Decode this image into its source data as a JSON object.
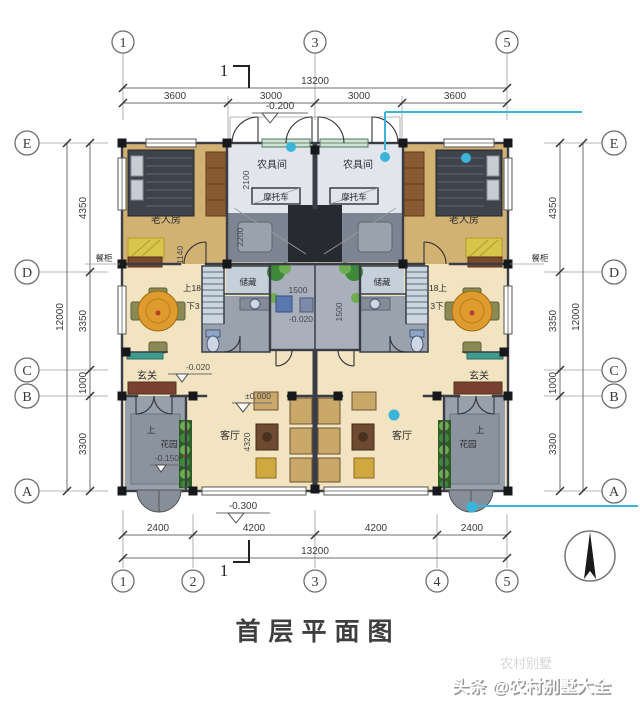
{
  "title": "首层平面图",
  "section_marker": "1",
  "axes": {
    "top": [
      "1",
      "3",
      "5"
    ],
    "bottom": [
      "1",
      "2",
      "3",
      "4",
      "5"
    ],
    "left": [
      "E",
      "D",
      "C",
      "B",
      "A"
    ],
    "right": [
      "E",
      "D",
      "C",
      "B",
      "A"
    ]
  },
  "dimensions": {
    "top": {
      "total": "13200",
      "segments": [
        "3600",
        "3000",
        "3000",
        "3600"
      ]
    },
    "bottom": {
      "total": "13200",
      "segments": [
        "2400",
        "4200",
        "4200",
        "2400"
      ]
    },
    "left": {
      "total": "12000",
      "segments": [
        "4350",
        "3350",
        "1000",
        "3300"
      ]
    },
    "right": {
      "total": "12000",
      "segments": [
        "4350",
        "3350",
        "1000",
        "3300"
      ]
    },
    "interior": {
      "toolroom_depth": "2100",
      "parking_depth": "2200",
      "hall_width": "1140",
      "living_depth": "4320",
      "court_width": "1500",
      "court_depth": "1500"
    }
  },
  "levels": {
    "portico": "-0.200",
    "foyer": "-0.020",
    "court": "-0.020",
    "living": "±0.000",
    "garden": "-0.150",
    "front_step": "-0.300"
  },
  "rooms": {
    "bedroom": "老人房",
    "toolroom": "农具间",
    "motorcycle": "摩托车",
    "storage": "储藏",
    "foyer": "玄关",
    "living": "客厅",
    "cupboard": "餐柜",
    "garden_up": "上",
    "garden": "花园",
    "stair_up_left": "上18",
    "stair_down_left": "下3",
    "stair_up_right": "18上",
    "stair_down_right": "3下"
  },
  "watermark": {
    "prefix": "头条",
    "handle": "@农村别墅大全",
    "ghost": "农村别墅"
  },
  "colors": {
    "accent_cyan": "#3ab5d9",
    "bedroom_floor": "#d2b273",
    "living_floor": "#f2e4c0"
  }
}
